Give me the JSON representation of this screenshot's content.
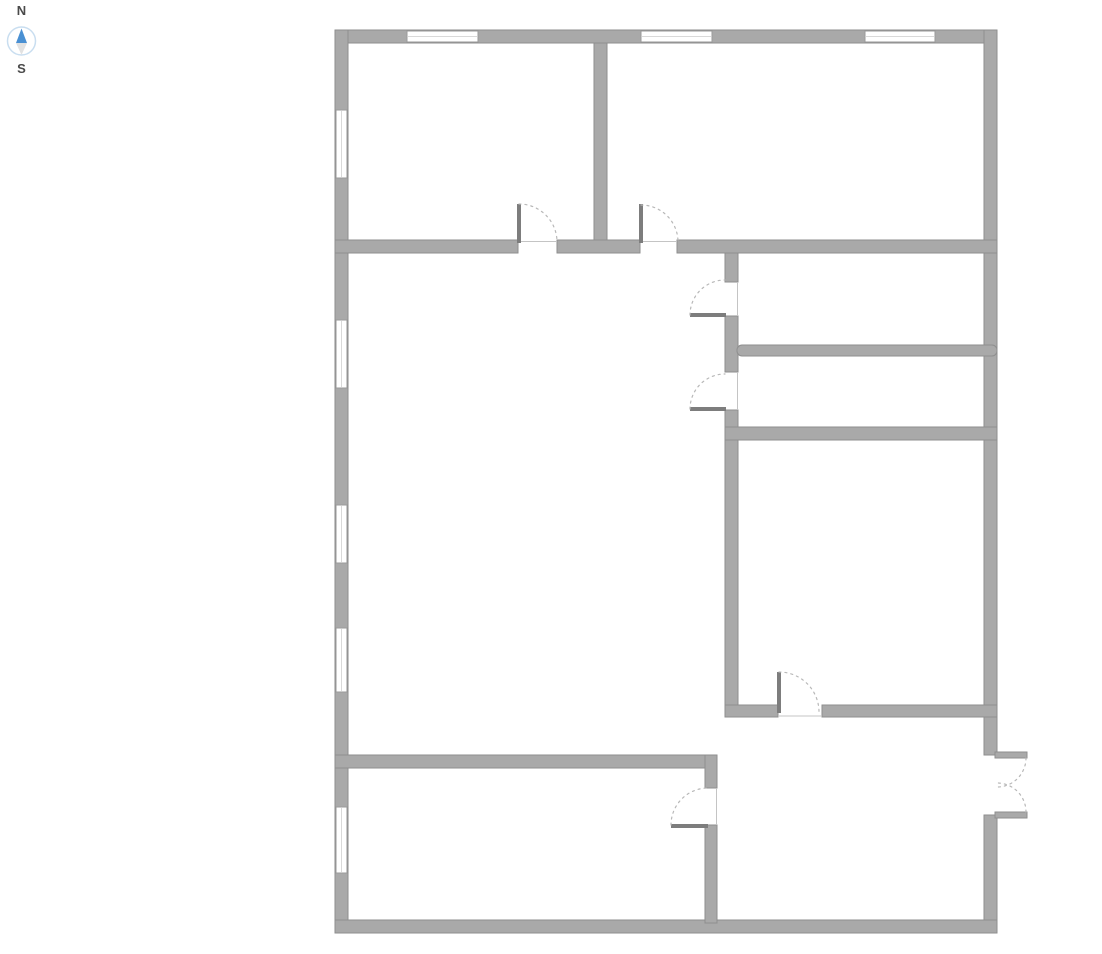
{
  "compass": {
    "north_label": "N",
    "south_label": "S",
    "label_color": "#4a4a4a",
    "ring_color": "#c9def0",
    "needle_north_color": "#4a90d3",
    "needle_south_color": "#e2e2e2"
  },
  "floorplan": {
    "wall_color": "#a9a9a9",
    "wall_edge_color": "#8e8e8e",
    "window_fill": "#ffffff",
    "window_frame_color": "#9a9a9a",
    "window_glazing_color": "#d9d9d9",
    "lintel_color": "#c4c4c4",
    "door_panel_color": "#7d7d7d",
    "door_arc_color": "#b8b8b8",
    "walls": [
      {
        "name": "exterior-top-wall",
        "x": 335,
        "y": 30,
        "w": 662,
        "h": 13
      },
      {
        "name": "exterior-left-wall",
        "x": 335,
        "y": 30,
        "w": 13,
        "h": 903
      },
      {
        "name": "exterior-right-wall-upper",
        "x": 984,
        "y": 30,
        "w": 13,
        "h": 725
      },
      {
        "name": "exterior-right-wall-lower",
        "x": 984,
        "y": 815,
        "w": 13,
        "h": 118
      },
      {
        "name": "exterior-bottom-wall",
        "x": 335,
        "y": 920,
        "w": 662,
        "h": 13
      },
      {
        "name": "top-rooms-divider-wall",
        "x": 594,
        "y": 43,
        "w": 13,
        "h": 198
      },
      {
        "name": "upper-hall-wall-west",
        "x": 335,
        "y": 240,
        "w": 183,
        "h": 13
      },
      {
        "name": "upper-hall-wall-mid",
        "x": 557,
        "y": 240,
        "w": 83,
        "h": 13
      },
      {
        "name": "upper-hall-wall-east",
        "x": 677,
        "y": 240,
        "w": 320,
        "h": 13
      },
      {
        "name": "hall-wall-segment-1",
        "x": 725,
        "y": 253,
        "w": 13,
        "h": 29
      },
      {
        "name": "hall-wall-segment-2",
        "x": 725,
        "y": 316,
        "w": 13,
        "h": 56
      },
      {
        "name": "hall-wall-segment-3",
        "x": 725,
        "y": 410,
        "w": 13,
        "h": 307
      },
      {
        "name": "small-rooms-divider-wall",
        "x": 737,
        "y": 345,
        "w": 260,
        "h": 11,
        "rx": 5
      },
      {
        "name": "bedroom-top-wall",
        "x": 725,
        "y": 427,
        "w": 272,
        "h": 13
      },
      {
        "name": "bedroom-bottom-wall-west",
        "x": 725,
        "y": 705,
        "w": 53,
        "h": 12
      },
      {
        "name": "bedroom-bottom-wall-east",
        "x": 822,
        "y": 705,
        "w": 175,
        "h": 12
      },
      {
        "name": "garage-top-wall",
        "x": 335,
        "y": 755,
        "w": 382,
        "h": 13
      },
      {
        "name": "garage-right-wall-upper",
        "x": 705,
        "y": 755,
        "w": 12,
        "h": 33
      },
      {
        "name": "garage-right-wall-lower",
        "x": 705,
        "y": 825,
        "w": 12,
        "h": 98
      },
      {
        "name": "entry-door-leaf-upper",
        "x": 995,
        "y": 752,
        "w": 32,
        "h": 6
      },
      {
        "name": "entry-door-leaf-lower",
        "x": 995,
        "y": 812,
        "w": 32,
        "h": 6
      }
    ],
    "windows": [
      {
        "name": "window-top-1",
        "x": 407,
        "y": 31,
        "w": 71,
        "h": 11
      },
      {
        "name": "window-top-2",
        "x": 641,
        "y": 31,
        "w": 71,
        "h": 11
      },
      {
        "name": "window-top-3",
        "x": 865,
        "y": 31,
        "w": 70,
        "h": 11
      },
      {
        "name": "window-left-1",
        "x": 336,
        "y": 110,
        "w": 11,
        "h": 68
      },
      {
        "name": "window-left-2",
        "x": 336,
        "y": 320,
        "w": 11,
        "h": 68
      },
      {
        "name": "window-left-3",
        "x": 336,
        "y": 505,
        "w": 11,
        "h": 58
      },
      {
        "name": "window-left-4",
        "x": 336,
        "y": 628,
        "w": 11,
        "h": 64
      },
      {
        "name": "window-left-5",
        "x": 336,
        "y": 807,
        "w": 11,
        "h": 66
      }
    ],
    "lintels": [
      {
        "name": "threshold-top-left-door",
        "x1": 518,
        "y1": 241.5,
        "x2": 557,
        "y2": 241.5
      },
      {
        "name": "threshold-top-right-door",
        "x1": 640,
        "y1": 241.5,
        "x2": 677,
        "y2": 241.5
      },
      {
        "name": "threshold-hall-door-1",
        "x1": 737.5,
        "y1": 282,
        "x2": 737.5,
        "y2": 316
      },
      {
        "name": "threshold-hall-door-2",
        "x1": 737.5,
        "y1": 372,
        "x2": 737.5,
        "y2": 410
      },
      {
        "name": "threshold-bedroom-door",
        "x1": 778,
        "y1": 716,
        "x2": 822,
        "y2": 716
      },
      {
        "name": "threshold-garage-door",
        "x1": 716.5,
        "y1": 788,
        "x2": 716.5,
        "y2": 825
      }
    ],
    "door_panels": [
      {
        "name": "top-left-room-door-panel",
        "x": 517,
        "y": 204,
        "w": 4,
        "h": 39
      },
      {
        "name": "top-right-room-door-panel",
        "x": 639,
        "y": 204,
        "w": 4,
        "h": 39
      },
      {
        "name": "hall-door-1-panel",
        "x": 690,
        "y": 313,
        "w": 36,
        "h": 4
      },
      {
        "name": "hall-door-2-panel",
        "x": 690,
        "y": 407,
        "w": 36,
        "h": 4
      },
      {
        "name": "bedroom-door-panel",
        "x": 777,
        "y": 672,
        "w": 4,
        "h": 41
      },
      {
        "name": "garage-door-panel",
        "x": 671,
        "y": 824,
        "w": 37,
        "h": 4
      }
    ],
    "door_arcs": [
      {
        "name": "top-left-room-door-arc",
        "d": "M 519 204 A 38 38 0 0 1 557 242"
      },
      {
        "name": "top-right-room-door-arc",
        "d": "M 641 205 A 37 37 0 0 1 678 242"
      },
      {
        "name": "hall-door-1-arc",
        "d": "M 690 315 A 35 35 0 0 1 725 280"
      },
      {
        "name": "hall-door-2-arc",
        "d": "M 690 409 A 35 35 0 0 1 725 374"
      },
      {
        "name": "bedroom-door-arc",
        "d": "M 779 672 A 40 40 0 0 1 819 712"
      },
      {
        "name": "garage-door-arc",
        "d": "M 671 825 A 37 37 0 0 1 708 788"
      },
      {
        "name": "entry-door-arc-upper",
        "d": "M 1026 758 A 29 29 0 0 1 997 787"
      },
      {
        "name": "entry-door-arc-lower",
        "d": "M 1026 812 A 29 29 0 0 0 997 783"
      }
    ]
  }
}
